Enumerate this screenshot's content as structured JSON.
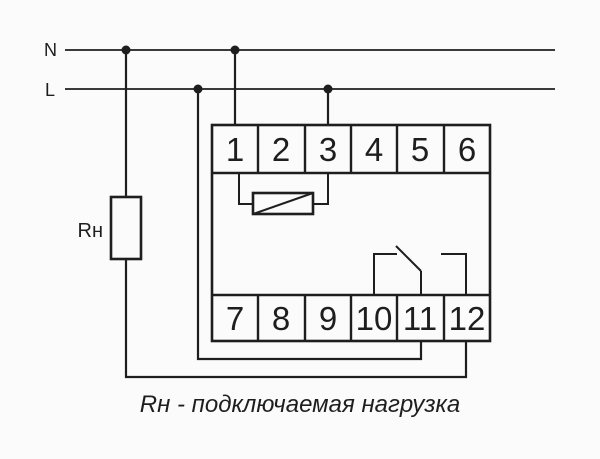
{
  "colors": {
    "background": "#fbfbfb",
    "stroke": "#1e1e1e"
  },
  "rails": {
    "neutral_label": "N",
    "phase_label": "L"
  },
  "load": {
    "label": "Rн"
  },
  "device": {
    "top_terminals": [
      "1",
      "2",
      "3",
      "4",
      "5",
      "6"
    ],
    "bottom_terminals": [
      "7",
      "8",
      "9",
      "10",
      "11",
      "12"
    ]
  },
  "caption": "Rн - подключаемая нагрузка"
}
